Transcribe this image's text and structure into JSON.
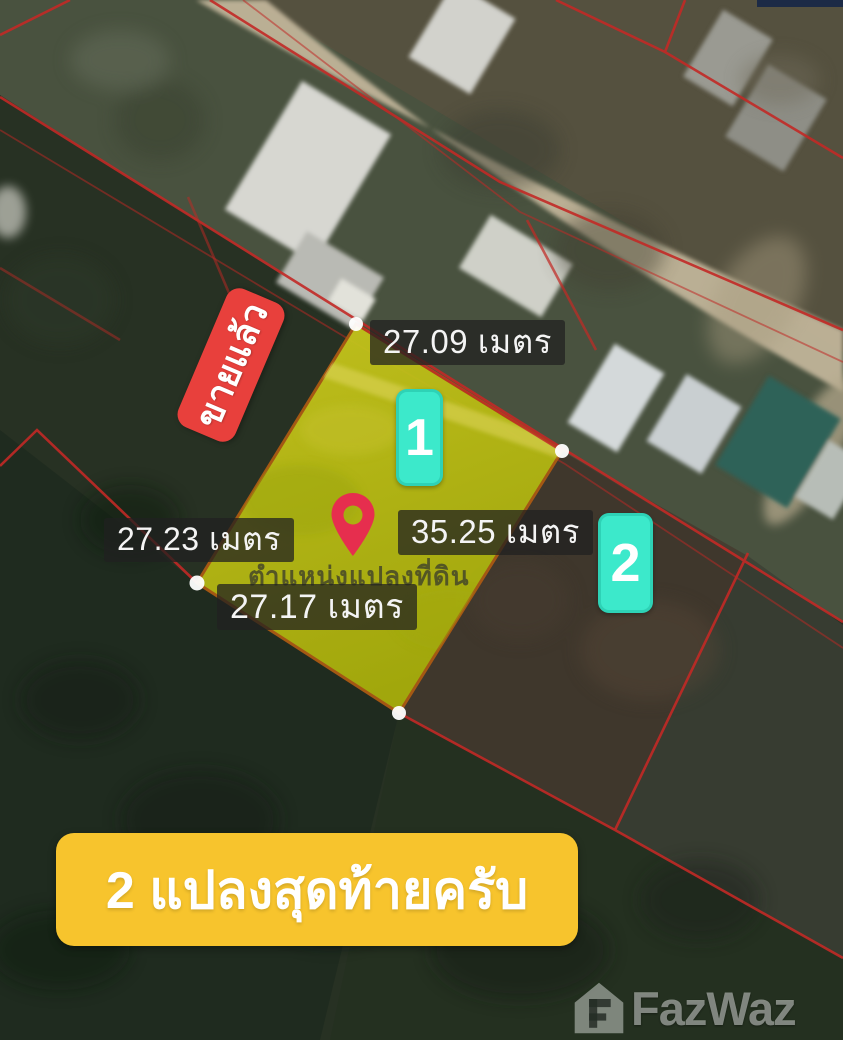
{
  "map": {
    "type": "satellite-land-plot-listing",
    "sold_badge": "ขายแล้ว",
    "plot_caption": "ตำแหน่งแปลงที่ดิน",
    "measurements": {
      "top": "27.09 เมตร",
      "left": "27.23 เมตร",
      "right": "35.25 เมตร",
      "bottom": "27.17 เมตร"
    },
    "plot_badges": [
      {
        "label": "1"
      },
      {
        "label": "2"
      }
    ],
    "banner": "2 แปลงสุดท้ายครับ",
    "watermark": "FazWaz",
    "colors": {
      "sold_badge_red": "#e8403c",
      "plot_badge_teal": "#3ce9cb",
      "banner_yellow": "#f7c42d",
      "plot_fill_yellow": "#b9bd17",
      "plot_border_orange": "#ab5a14",
      "cadastral_line_red": "#c22a26",
      "pin_red": "#e62e4e",
      "label_background": "rgba(33,33,33,0.74)"
    }
  }
}
